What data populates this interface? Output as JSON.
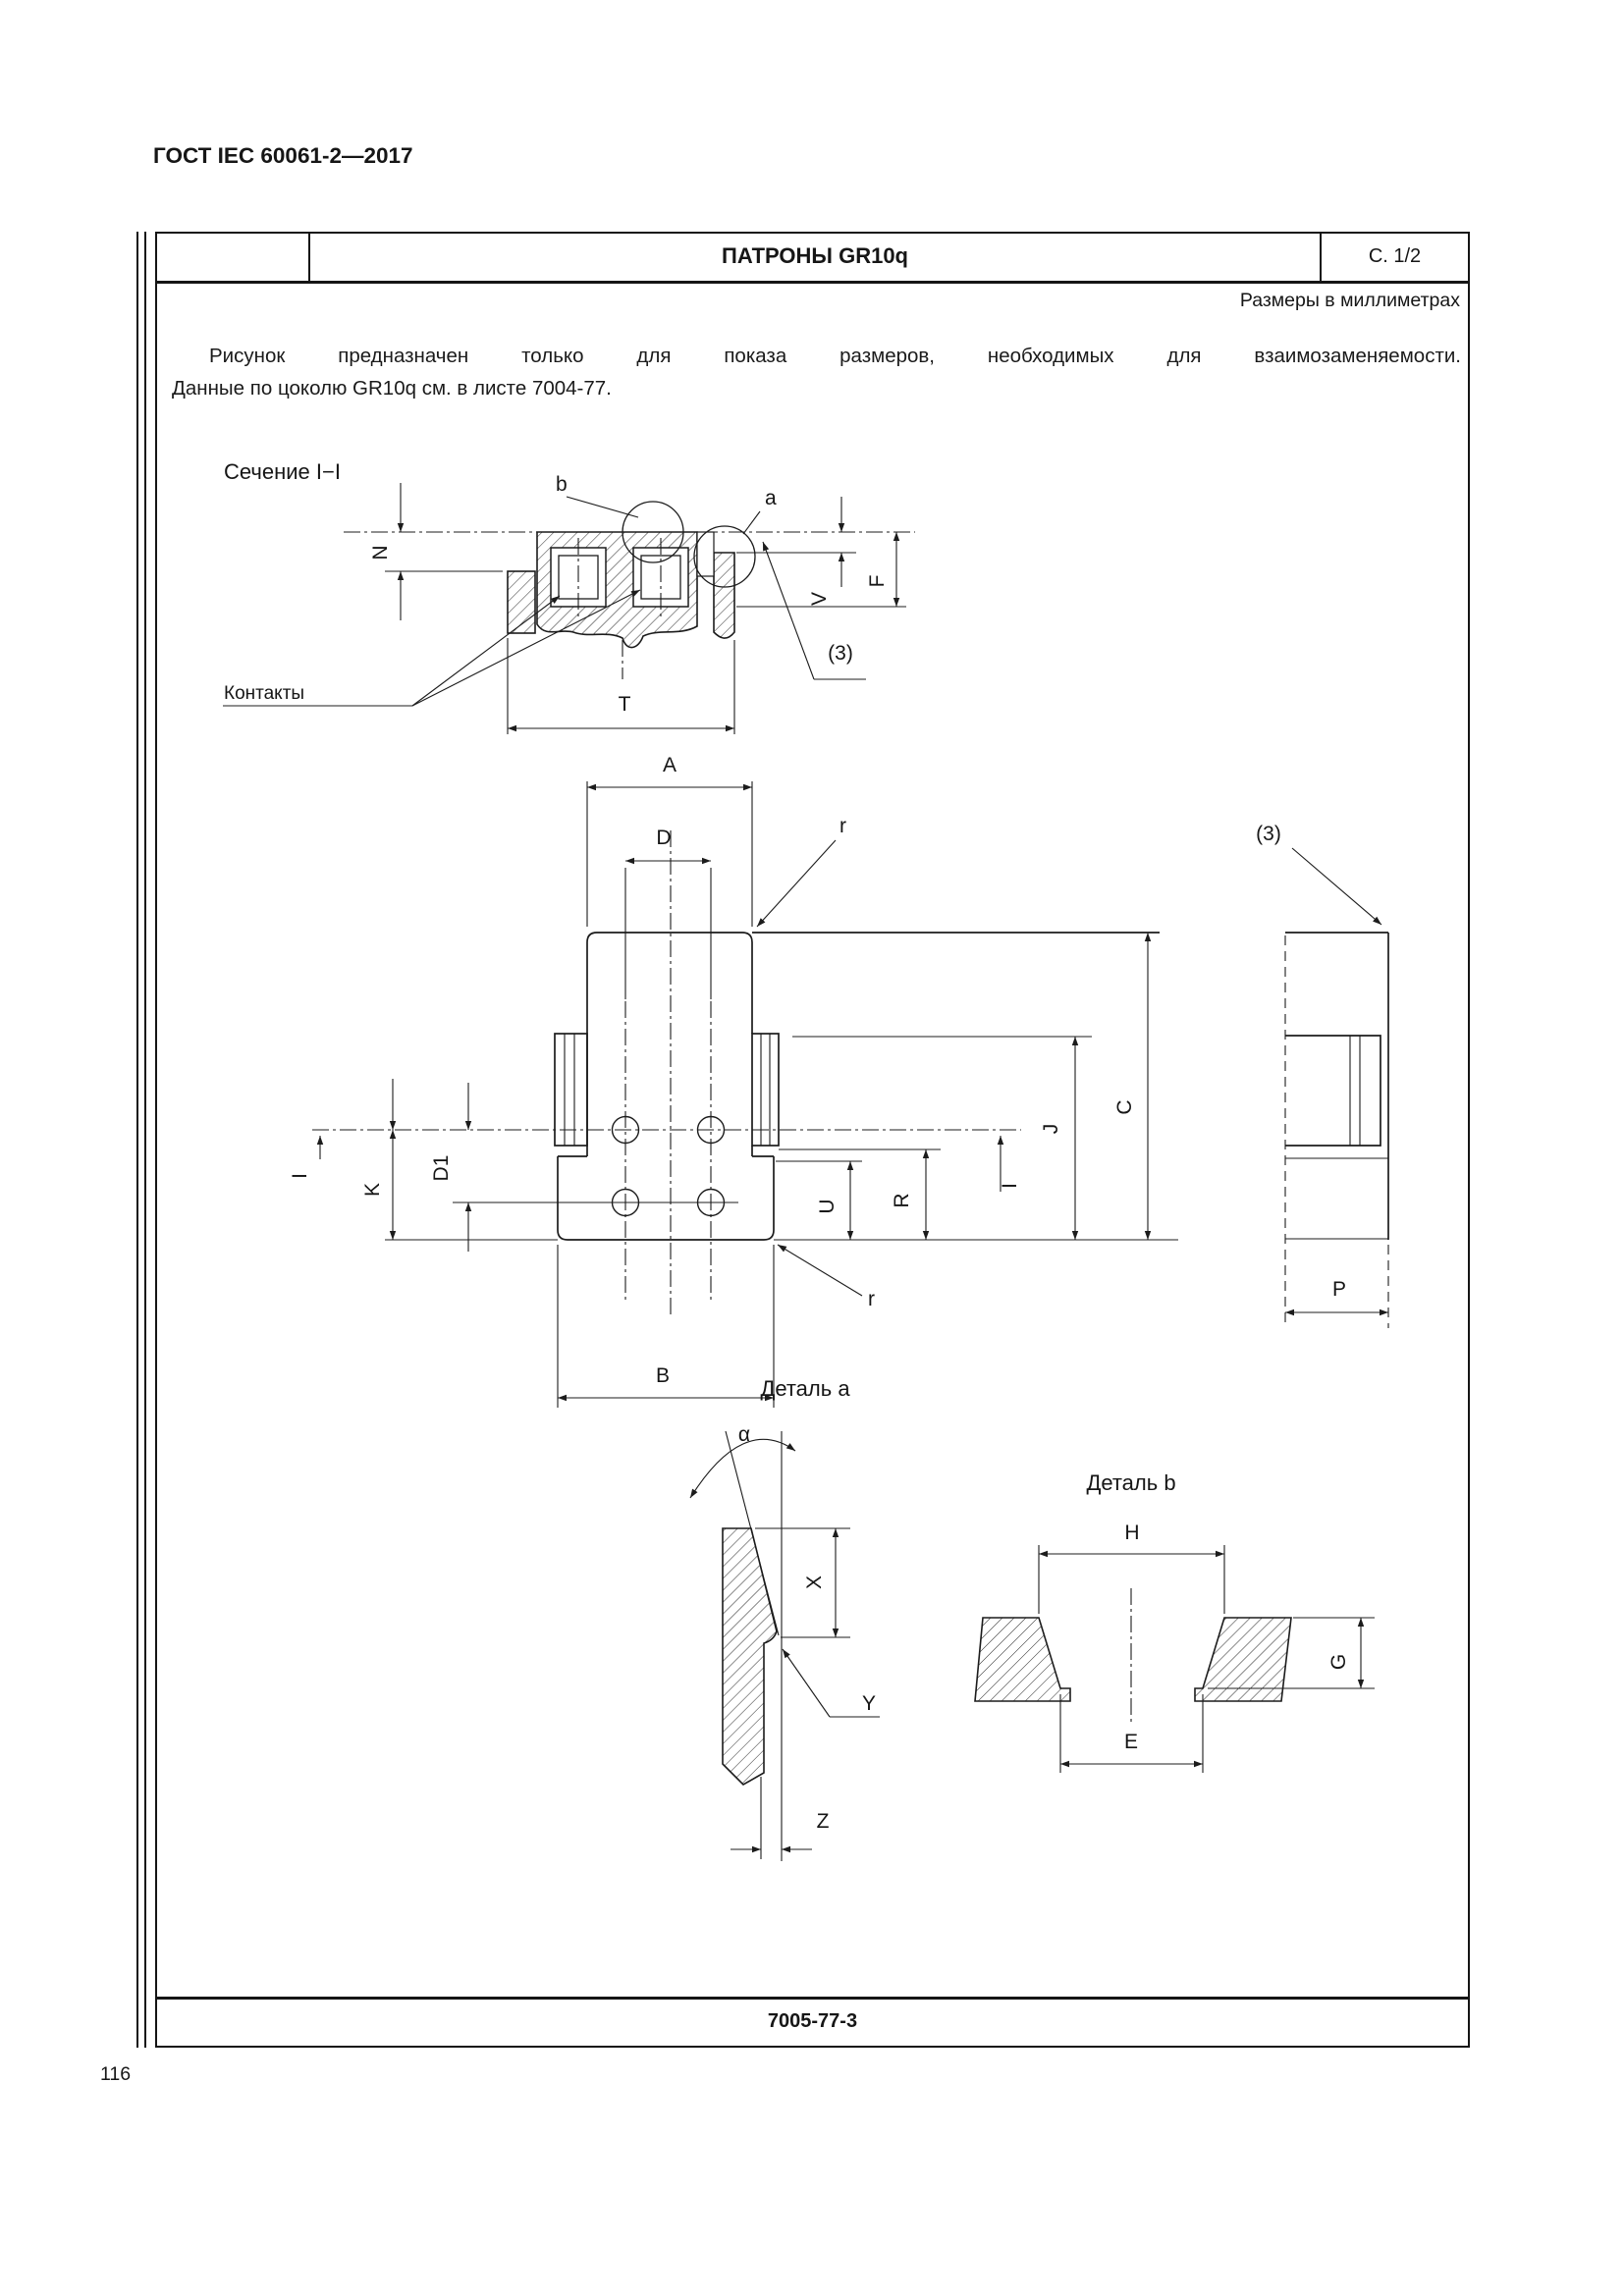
{
  "page": {
    "standard_ref": "ГОСТ IEC 60061-2—2017",
    "page_number": "116"
  },
  "sheet": {
    "title": "ПАТРОНЫ GR10q",
    "page_marker": "С. 1/2",
    "units_note": "Размеры в миллиметрах",
    "intro_line_1": "Рисунок предназначен только для показа размеров, необходимых для взаимозаменяемости.",
    "intro_line_2": "Данные по цоколю GR10q см. в листе 7004-77.",
    "footer_code": "7005-77-3"
  },
  "section_view": {
    "caption": "Сечение I−I",
    "contacts_label": "Контакты",
    "labels": {
      "b": "b",
      "a": "a",
      "N": "N",
      "V": "V",
      "F": "F",
      "T": "T",
      "note3": "(3)"
    }
  },
  "front_view": {
    "labels": {
      "A": "A",
      "D": "D",
      "r": "r",
      "B": "B",
      "K": "K",
      "D1": "D1",
      "U": "U",
      "R": "R",
      "J": "J",
      "C": "C",
      "I": "I",
      "note3": "(3)",
      "P": "P"
    }
  },
  "detail_a": {
    "caption": "Деталь a",
    "labels": {
      "alpha": "α",
      "X": "X",
      "Y": "Y",
      "Z": "Z"
    }
  },
  "detail_b": {
    "caption": "Деталь b",
    "labels": {
      "H": "H",
      "E": "E",
      "G": "G"
    }
  }
}
